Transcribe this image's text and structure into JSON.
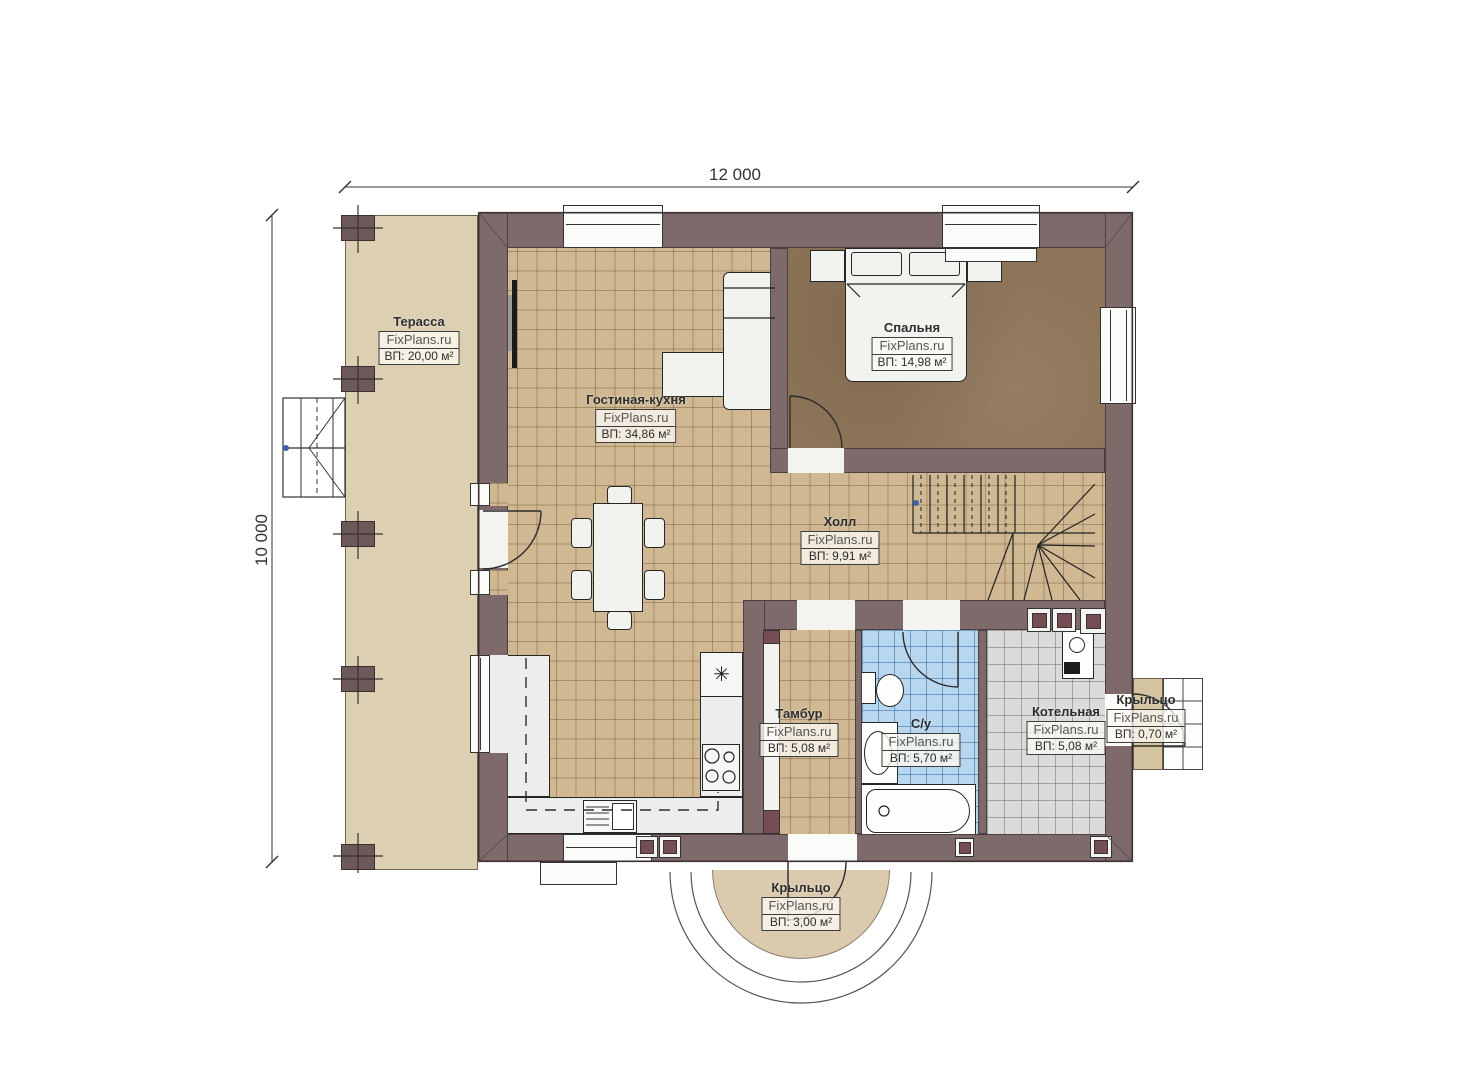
{
  "page": {
    "title": "План 1 этажа"
  },
  "watermark": "FixPlans.ru",
  "dimensions": {
    "width_label": "12 000",
    "height_label": "10 000"
  },
  "rooms": [
    {
      "name": "Терасса",
      "area": "ВП: 20,00 м²"
    },
    {
      "name": "Гостиная-кухня",
      "area": "ВП: 34,86 м²"
    },
    {
      "name": "Спальня",
      "area": "ВП: 14,98 м²"
    },
    {
      "name": "Холл",
      "area": "ВП: 9,91 м²"
    },
    {
      "name": "Тамбур",
      "area": "ВП: 5,08 м²"
    },
    {
      "name": "С/у",
      "area": "ВП: 5,70 м²"
    },
    {
      "name": "Котельная",
      "area": "ВП: 5,08 м²"
    },
    {
      "name": "Крыльцо",
      "area": "ВП: 0,70 м²"
    },
    {
      "name": "Крыльцо",
      "area": "ВП: 3,00 м²"
    }
  ],
  "symbols": {
    "fridge": "✳"
  },
  "colors": {
    "wall": "#7e696b",
    "floor_main": "#cfb892",
    "floor_bedroom": "#8d7458",
    "floor_bath": "#b9d6ef",
    "floor_boiler": "#dbdbdb",
    "terrace": "#ddcfb2",
    "accent_square": "#744e52"
  }
}
